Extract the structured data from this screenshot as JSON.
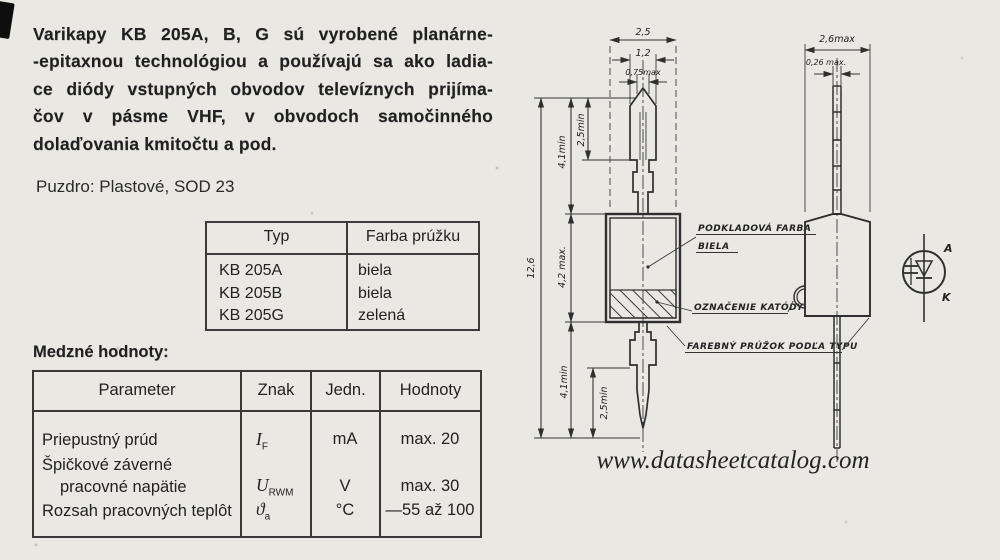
{
  "page": {
    "background": "#e9e8e3",
    "ink": "#1c1c1c",
    "line_color": "#2f2f2f",
    "watermark": "www.datasheetcatalog.com"
  },
  "intro": {
    "lines": [
      "Varikapy KB 205A, B, G sú vyrobené planárne-",
      "-epitaxnou technológiou a používajú sa ako ladia-",
      "ce diódy vstupných obvodov televíznych prijíma-",
      "čov v pásme VHF, v obvodoch samočinného",
      "dolaďovania kmitočtu a pod."
    ]
  },
  "package_line": "Puzdro: Plastové, SOD 23",
  "type_table": {
    "headers": [
      "Typ",
      "Farba prúžku"
    ],
    "rows": [
      [
        "KB 205A",
        "biela"
      ],
      [
        "KB 205B",
        "biela"
      ],
      [
        "KB 205G",
        "zelená"
      ]
    ]
  },
  "limits": {
    "heading": "Medzné hodnoty:",
    "headers": [
      "Parameter",
      "Znak",
      "Jedn.",
      "Hodnoty"
    ],
    "rows": [
      {
        "p": "Priepustný prúd",
        "sym": "I",
        "sub": "F",
        "unit": "mA",
        "val": "max. 20"
      },
      {
        "p": "Špičkové záverné"
      },
      {
        "p": "pracovné napätie",
        "sym": "U",
        "sub": "RWM",
        "unit": "V",
        "val": "max. 30"
      },
      {
        "p": "Rozsah pracovných teplôt",
        "sym": "ϑ",
        "sub": "a",
        "unit": "°C",
        "val": "—55 až 100"
      }
    ]
  },
  "figure": {
    "front": {
      "w1": "2,5",
      "w2": "1,2",
      "w3": "0,75max",
      "total": "12,6",
      "body": "4,2 max.",
      "lead_top": "4,1min",
      "lead_top_straight": "2,5min",
      "lead_bottom": "4,1min",
      "lead_bottom_straight": "2,5min"
    },
    "side": {
      "w": "2,6max",
      "t": "0,26 max."
    },
    "labels": {
      "base_line1": "PODKLADOVÁ FARBA",
      "base_line2": "BIELA",
      "cathode": "OZNAČENIE KATÓDY",
      "stripe": "FAREBNÝ PRÚŽOK PODĽA TYPU"
    },
    "symbol": {
      "anode": "A",
      "cathode": "K"
    }
  }
}
